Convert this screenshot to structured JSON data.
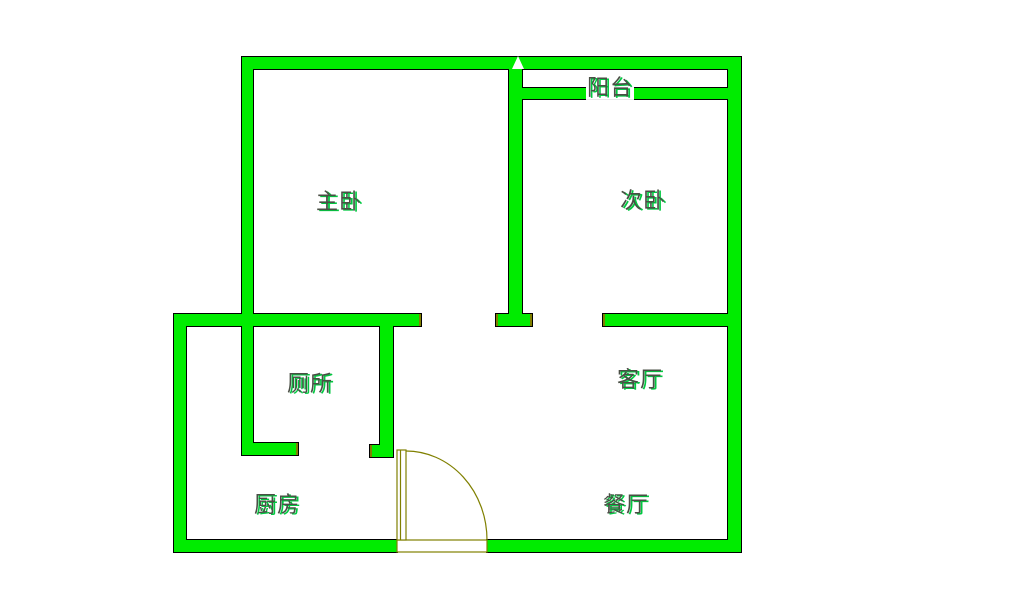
{
  "diagram_type": "apartment-floor-plan",
  "colors": {
    "wall_fill": "#00ec00",
    "wall_outline": "#000000",
    "door_color": "#808000",
    "label_color": "#4a4f45",
    "label_highlight": "#00c840",
    "background": "#ffffff"
  },
  "rooms": {
    "master_bedroom": "主卧",
    "second_bedroom": "次卧",
    "balcony": "阳台",
    "toilet": "厕所",
    "living_room": "客厅",
    "kitchen": "厨房",
    "dining_room": "餐厅"
  }
}
